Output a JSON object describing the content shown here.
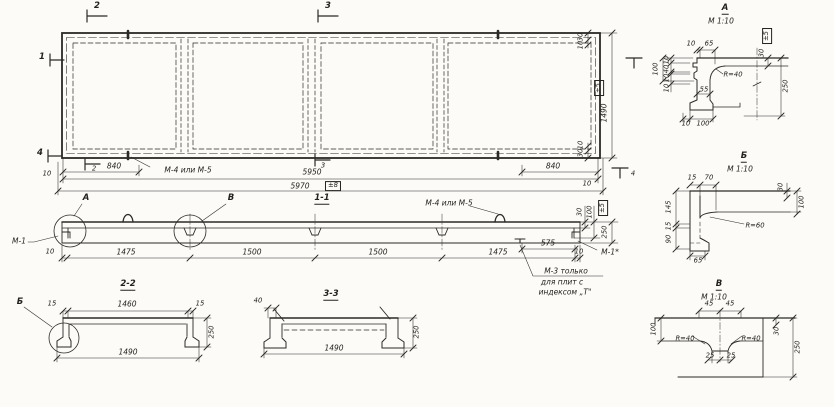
{
  "sheet": {
    "background": "#fcfbf8",
    "ink": "#2b2a26"
  },
  "plan": {
    "marker_top_2": "2",
    "marker_top_3": "3",
    "marker_left_1": "1",
    "marker_left_4": "4",
    "marker_bottom_2": "2",
    "marker_bottom_3": "3",
    "marker_right_4": "4",
    "dim_840_left": "840",
    "dim_840_right": "840",
    "dim_margin_left": "10",
    "dim_margin_right": "10",
    "dim_5950": "5950",
    "dim_5970": "5970",
    "tol_5970": "±8",
    "dim_edge_top_30": "30",
    "dim_edge_top_10": "10",
    "dim_edge_bottom_10": "10",
    "dim_edge_bottom_30": "30",
    "dim_1490": "1490",
    "tol_1490": "±5",
    "note_m4": "М-4 или М-5"
  },
  "sec11": {
    "label": "1-1",
    "callout_a": "А",
    "callout_b": "В",
    "label_m1_left": "М-1",
    "label_m1_right": "М-1*",
    "note_m4": "М-4 или М-5",
    "note_m3_line1": "М-3 только",
    "note_m3_line2": "для плит с",
    "note_m3_line3": "индексом „Т\"",
    "dim_10_left": "10",
    "dim_1475_a": "1475",
    "dim_1500_a": "1500",
    "dim_1500_b": "1500",
    "dim_1475_b": "1475",
    "dim_575": "575",
    "dim_10_right": "10",
    "dim_30": "30",
    "dim_100": "100",
    "tol": "±5",
    "dim_250": "250"
  },
  "sec22": {
    "label": "2-2",
    "callout_b": "Б",
    "dim_15_left": "15",
    "dim_1460": "1460",
    "dim_15_right": "15",
    "dim_250": "250",
    "dim_1490": "1490"
  },
  "sec33": {
    "label": "3-3",
    "dim_40": "40",
    "dim_250": "250",
    "dim_1490": "1490"
  },
  "detail_a": {
    "title": "А",
    "scale": "М 1:10",
    "dim_10_top": "10",
    "dim_65": "65",
    "tol": "±5",
    "dim_30": "30",
    "dim_100_left": "100",
    "dim_10_a": "10",
    "dim_40": "40",
    "dim_10_b": "10",
    "dim_10_c": "10",
    "dim_55": "55",
    "radius": "R=40",
    "dim_10_bottom": "10",
    "dim_100_bottom": "100",
    "dim_250": "250"
  },
  "detail_b": {
    "title": "Б",
    "scale": "М 1:10",
    "dim_15_top": "15",
    "dim_70": "70",
    "dim_145": "145",
    "dim_15_left": "15",
    "dim_90": "90",
    "dim_65": "65",
    "radius": "R=60",
    "dim_30": "30",
    "dim_100": "100"
  },
  "detail_v": {
    "title": "В",
    "scale": "М 1:10",
    "dim_45_left": "45",
    "dim_45_right": "45",
    "dim_100": "100",
    "radius_left": "R=40",
    "radius_right": "R=40",
    "dim_25_left": "25",
    "dim_25_right": "25",
    "dim_30": "30",
    "dim_250": "250"
  }
}
